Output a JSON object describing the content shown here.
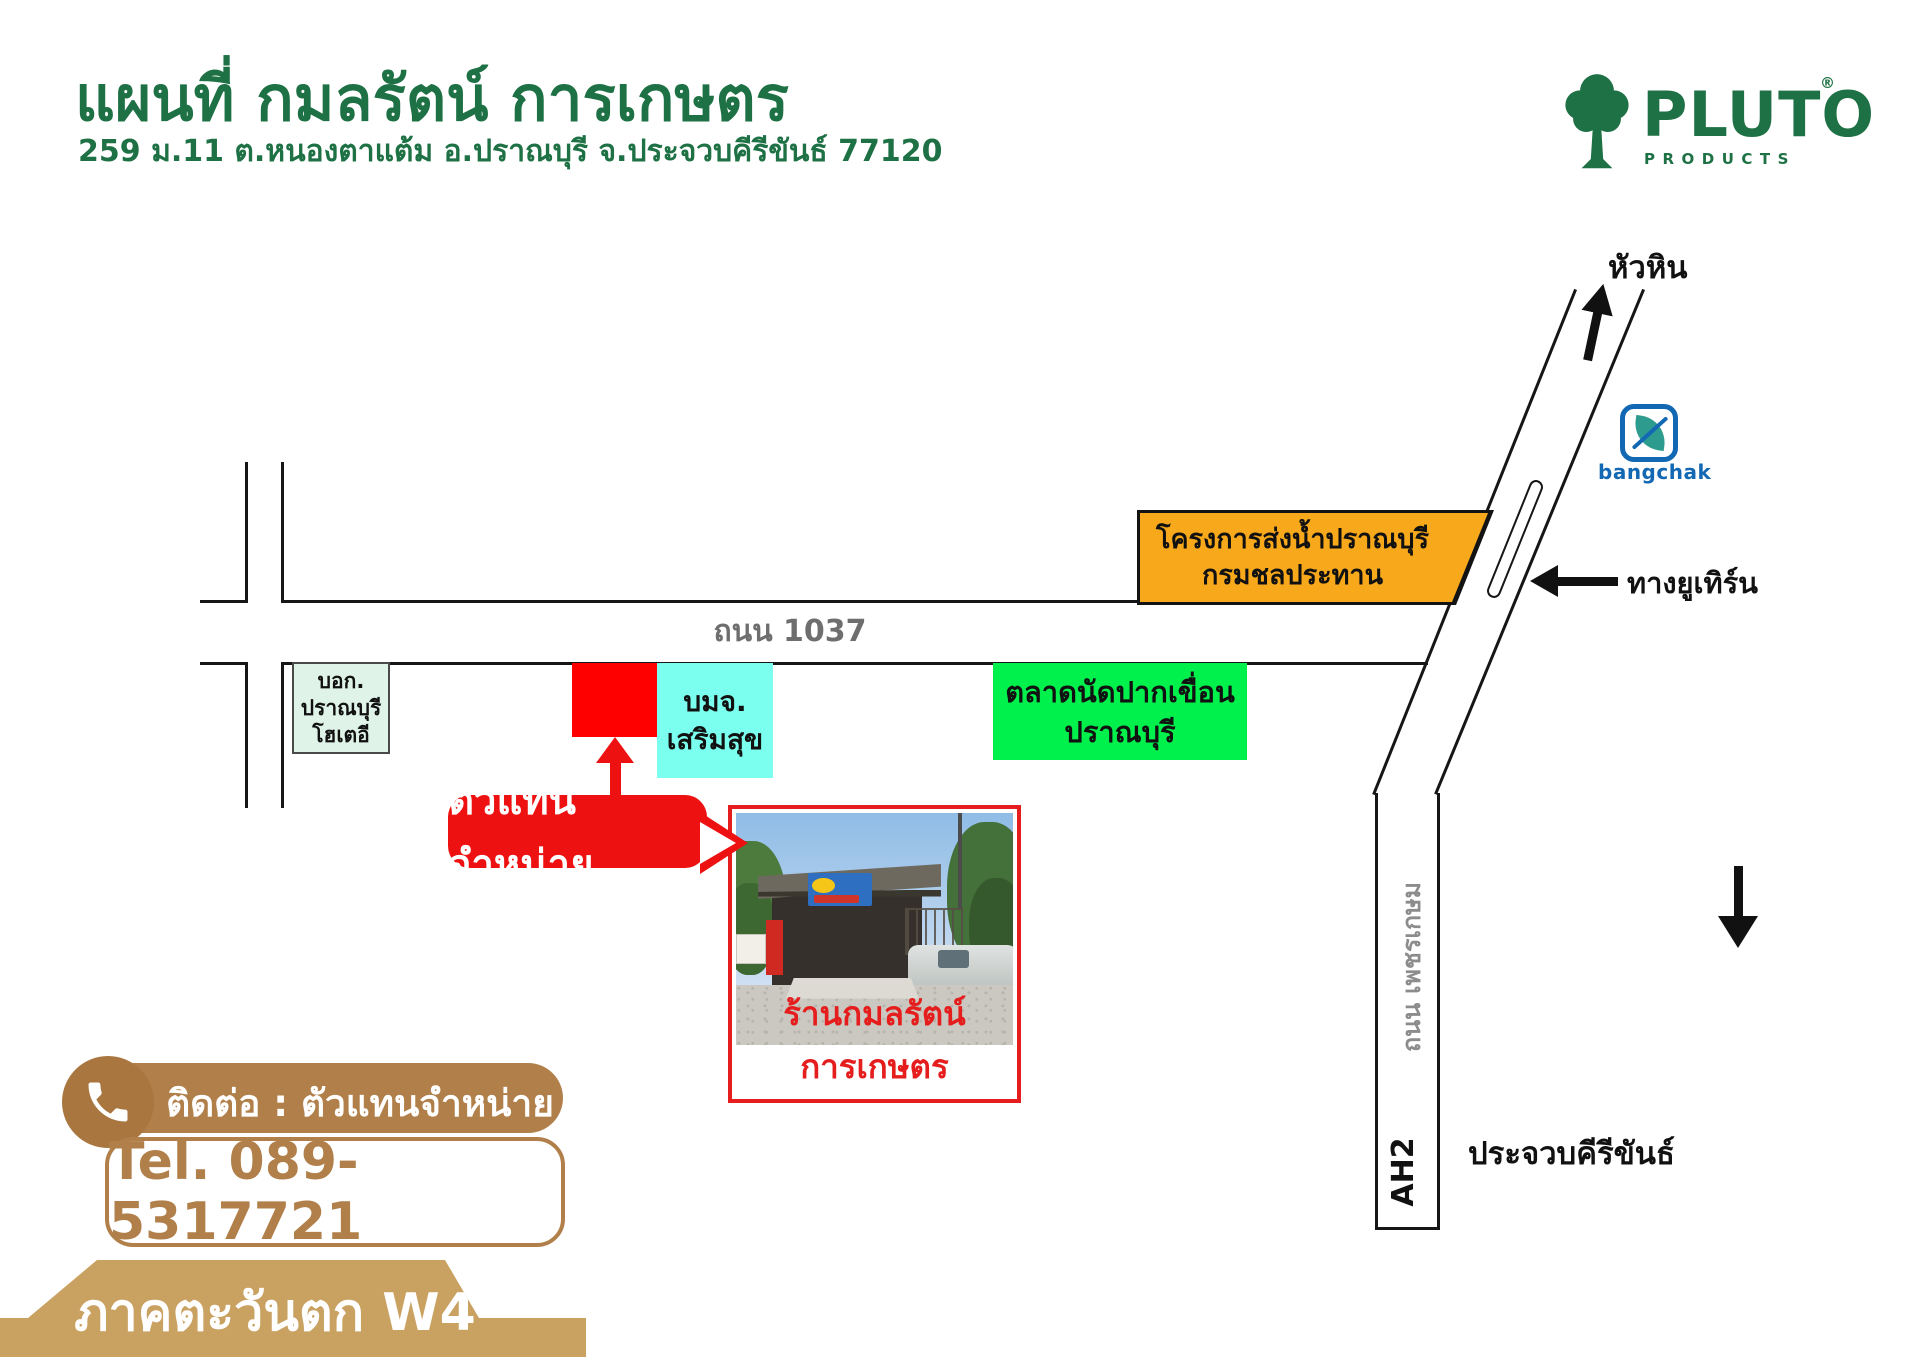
{
  "header": {
    "title": "แผนที่ กมลรัตน์ การเกษตร",
    "address": "259 ม.11 ต.หนองตาแต้ม อ.ปราณบุรี จ.ประจวบคีรีขันธ์ 77120",
    "brand": {
      "name": "PLUTO",
      "sub": "PRODUCTS",
      "reg": "®"
    }
  },
  "map": {
    "dest_top": "หัวหิน",
    "uturn_label": "ทางยูเทิร์น",
    "road1037": "ถนน 1037",
    "phetkasem": "ถนน เพชรเกษม",
    "ah2": "AH2",
    "dest_bottom": "ประจวบคีรีขันธ์",
    "bangchak": "bangchak",
    "irrigation": {
      "line1": "โครงการส่งน้ำปราณบุรี",
      "line2": "กรมชลประทาน"
    },
    "hotel": {
      "line1": "บอก.",
      "line2": "ปราณบุรี",
      "line3": "โฮเตอี"
    },
    "sermsuk": {
      "line1": "บมจ.",
      "line2": "เสริมสุข"
    },
    "market": {
      "line1": "ตลาดนัดปากเขื่อน",
      "line2": "ปราณบุรี"
    },
    "dealer_label": "ตัวแทนจำหน่าย",
    "photo_caption": "ร้านกมลรัตน์การเกษตร"
  },
  "contact": {
    "label": "ติดต่อ : ตัวแทนจำหน่าย",
    "tel": "Tel. 089-5317721"
  },
  "footer": {
    "region": "ภาคตะวันตก W4"
  },
  "colors": {
    "brand_green": "#1E7145",
    "orange": "#F7A81B",
    "mint": "#DFF3E8",
    "marker_red": "#FF0000",
    "cyan": "#7BFFEE",
    "market_green": "#00F04C",
    "label_red": "#ED1111",
    "brown": "#B1804A",
    "ribbon_tan": "#C9A161",
    "bangchak_blue": "#1268B3",
    "bangchak_teal": "#2D9B8E"
  }
}
